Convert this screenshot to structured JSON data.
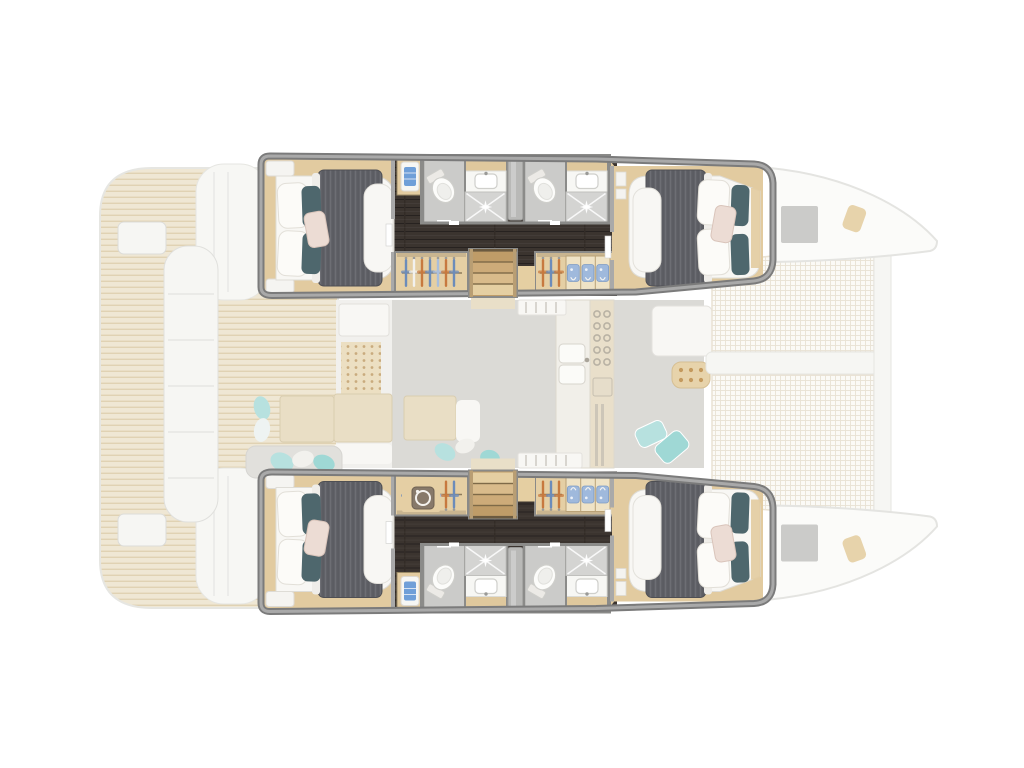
{
  "meta": {
    "description": "Catamaran yacht floor plan, top-down view. Four-cabin lower-deck accommodation highlighted in full colour inside the two hulls; main deck (saloon, galley, cockpit, foredeck trampoline) shown ghosted underneath.",
    "orientation": {
      "bow": "right",
      "stern": "left",
      "top_hull": "port",
      "bottom_hull": "starboard"
    }
  },
  "diagram_data": {
    "type": "floorplan",
    "hulls": [
      {
        "name": "port hull (top)",
        "rooms": [
          {
            "type": "double cabin",
            "position": "aft",
            "furniture": [
              "island double bed",
              "white linen",
              "grey duvet",
              "white pillows",
              "teal accent pillows",
              "blush cushion",
              "side cabinets"
            ]
          },
          {
            "type": "bathroom",
            "fixtures": [
              "toilet",
              "washbasin",
              "vanity",
              "shower with tiled tray"
            ]
          },
          {
            "type": "bathroom",
            "fixtures": [
              "toilet",
              "washbasin",
              "vanity",
              "shower with tiled tray"
            ]
          },
          {
            "type": "wardrobe",
            "contents": [
              "clothes on hangers"
            ]
          },
          {
            "type": "wardrobe",
            "contents": [
              "clothes on hangers",
              "three cubbies with folded gear"
            ]
          },
          {
            "type": "companionway stairs",
            "treads": 4
          },
          {
            "type": "towel niche",
            "contents": [
              "folded blue towel"
            ]
          },
          {
            "type": "double cabin",
            "position": "forward",
            "furniture": [
              "island double bed",
              "white linen",
              "grey duvet",
              "white pillows",
              "teal accent pillows",
              "blush cushion"
            ]
          }
        ]
      },
      {
        "name": "starboard hull (bottom)",
        "rooms": [
          "mirror image of port hull",
          {
            "type": "appliance",
            "item": "washing machine in aft wardrobe"
          }
        ]
      }
    ],
    "main_deck_ghosted": {
      "aft_deck": [
        "teak cockpit sole",
        "long cockpit sofa",
        "cockpit table",
        "aft bench with scatter cushions",
        "transom platforms",
        "boarding planks"
      ],
      "saloon": [
        "nav station",
        "speaker panel",
        "saloon table with bench",
        "dinette table with seat",
        "entry steps port and starboard"
      ],
      "galley": [
        "double sink",
        "five-burner stove",
        "oven",
        "fridge vents"
      ],
      "foredeck": [
        "forward lounge seat",
        "tray with glasses",
        "aqua scatter cushions",
        "two trampoline nets",
        "central walkway",
        "forward crossbeam",
        "two deck hatches",
        "bow fittings"
      ]
    },
    "icons": [
      "toilet-icon",
      "sink-icon",
      "shower-sparkle-icon",
      "hanger-icon",
      "folded-gear-icon",
      "towel-icon",
      "washing-machine-icon",
      "stove-burners-icon",
      "oven-icon"
    ]
  },
  "colors": {
    "background": "#ffffff",
    "wallStroke": "#7b7b7b",
    "wallInner": "#a9a9a9",
    "woodTrim": "#e2cba0",
    "woodTrimLight": "#dcc093",
    "floorDark": "#3b342f",
    "floorPlank": "#272220",
    "linen": "#f8f7f4",
    "linenStroke": "#dedcd6",
    "duvet": "#616268",
    "duvetEdge": "#4e4f54",
    "pillowWhite": "#fcfbf8",
    "pillowStroke": "#e2dfd8",
    "pillowTeal": "#4e676d",
    "pillowBlush": "#ecdcd4",
    "blushStroke": "#d9c4ba",
    "bathFloor": "#cbcbc9",
    "showerFloor": "#d4d4d2",
    "bathWall": "#8b8b89",
    "fixtureWhite": "#fcfcfa",
    "fixtureStroke": "#cfcfcb",
    "vanityWood": "#dfc89d",
    "pocketDoor": "#b9b9b7",
    "closetWood": "#e5cfa4",
    "closetStroke": "#8a8a88",
    "rod": "#8d7b5b",
    "hangerSteel": "#6c8cba",
    "hangerLight": "#a9bedc",
    "hangerOrange": "#c7793f",
    "hangerWhite": "#f2f1ee",
    "cubbyShirt": "#9fb9dc",
    "cubbyShirtStroke": "#7f9cc4",
    "stairDark": "#bf9c68",
    "stair2": "#cdab79",
    "stair3": "#d9bb8b",
    "stairLight": "#e5cfa2",
    "stairEdge": "#7e6a48",
    "stairSide": "#b99e73",
    "towel": "#6f9fd8",
    "teakBase": "#efe7d4",
    "teakLine": "#e0d2b3",
    "deckStroke": "#e6e6e2",
    "deckWhite": "#f6f6f3",
    "sternCap": "#f7f7f4",
    "saloonFloor": "#dbdad6",
    "saloonWhite": "#f1f0ed",
    "saloonFurnWhite": "#f8f7f4",
    "saloonWood": "#e9dec5",
    "saloonWoodStroke": "#d9cdb0",
    "dotPanel": "#ecdfc2",
    "dotColor": "#c9ab7e",
    "galleyCounter": "#f1efe9",
    "galleyWood": "#e9dfca",
    "applianceLine": "#b9b2a4",
    "fridgeLine": "#cdc6b8",
    "aqua": "#b7e1df",
    "aquaDeep": "#9fd8d5",
    "grayBench": "#e1e0dc",
    "netLine": "#e9e2d4",
    "netBase": "#fbfaf6",
    "beamWhite": "#f6f6f3",
    "bowFill": "#fbfbf9",
    "bowStroke": "#e4e4e1",
    "hatchGray": "#cbcbc9",
    "tanWedge": "#e7d3ab",
    "wmBody": "#87796a",
    "wmStroke": "#6e6152",
    "wmGlyph": "#f4f2ee"
  }
}
